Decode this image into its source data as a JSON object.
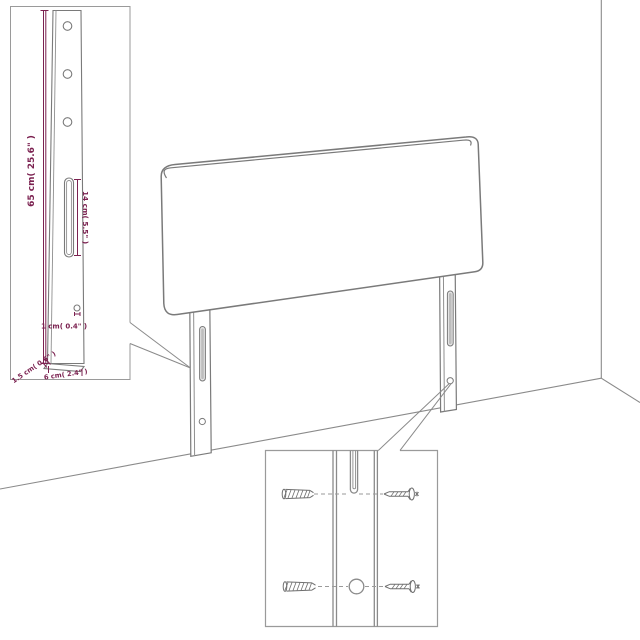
{
  "scene": {
    "description": "Line-art product diagram of a headboard with two mounting legs standing against a wall corner",
    "insets_count": 2
  },
  "colors": {
    "background": "#ffffff",
    "outline_gray": "#7a7a7a",
    "light_gray": "#9a9a9a",
    "dimension_magenta": "#7b2150",
    "slot_fill": "#d9d9d9"
  },
  "insets": {
    "leg_detail": {
      "title": "leg-dimension-detail",
      "labels": {
        "leg_height": "65 cm( 25.6\" )",
        "slot_length": "14 cm( 5.5\" )",
        "hole_size": "1 cm( 0.4\" )",
        "leg_thickness": "1.5 cm( 0.6\" )",
        "leg_width": "6 cm( 2.4\" )"
      }
    },
    "mounting_detail": {
      "title": "wall-mounting-hardware-detail",
      "hardware": [
        "wall-plug",
        "screw"
      ]
    }
  }
}
